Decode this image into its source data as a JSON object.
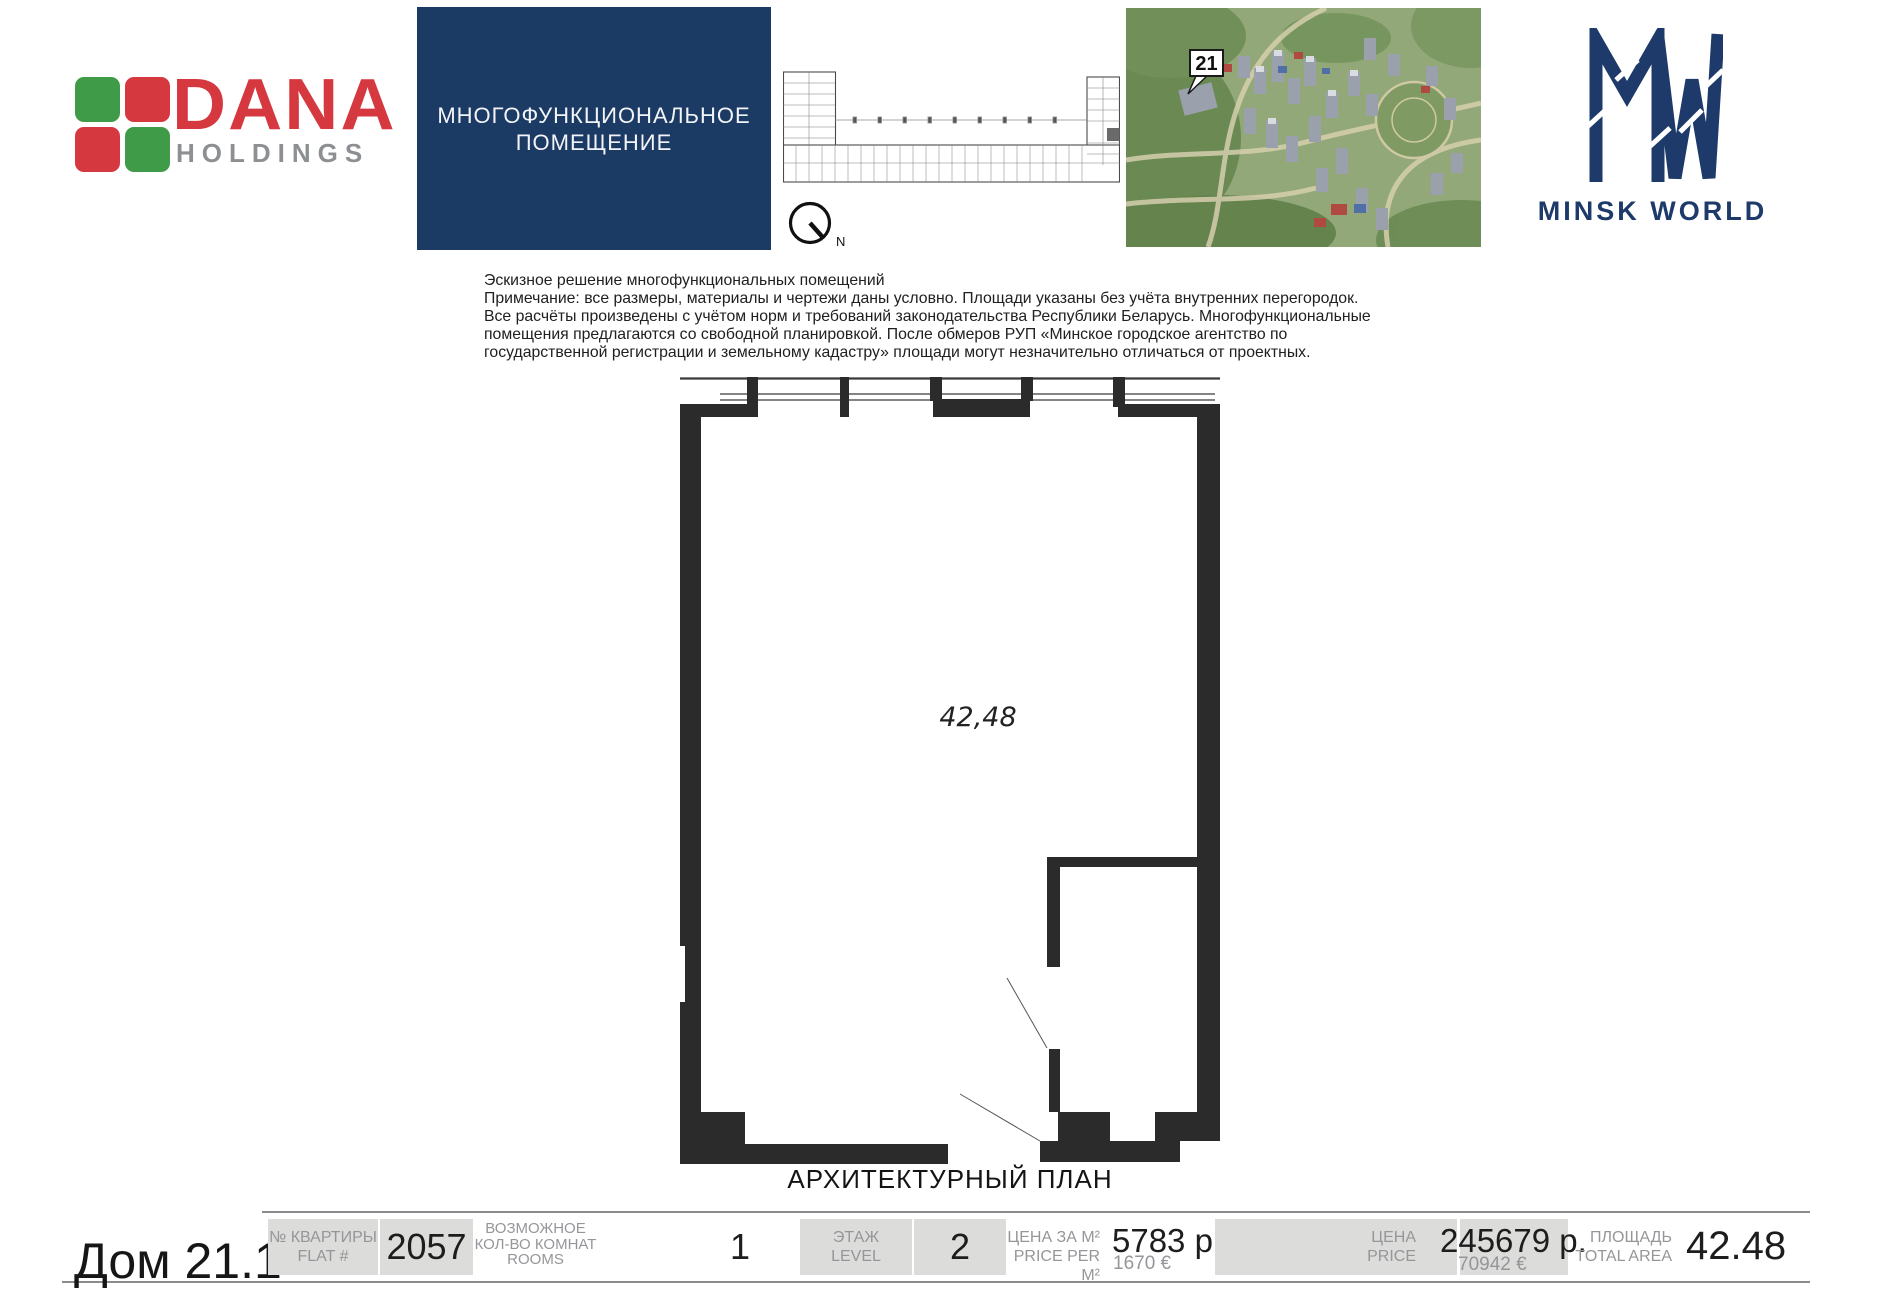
{
  "brand": {
    "dana_name": "DANA",
    "dana_sub": "HOLDINGS",
    "minsk_world": "MINSK WORLD"
  },
  "banner": {
    "line1": "МНОГОФУНКЦИОНАЛЬНОЕ",
    "line2": "ПОМЕЩЕНИЕ"
  },
  "site_plan": {
    "compass_label": "N",
    "building_marker": "21"
  },
  "disclaimer": {
    "lines": [
      "Эскизное решение многофункциональных помещений",
      "Примечание: все размеры, материалы и чертежи даны условно. Площади указаны без учёта внутренних перегородок.",
      "Все расчёты произведены с учётом норм и требований законодательства Республики Беларусь. Многофункциональные",
      "помещения предлагаются со свободной планировкой. После обмеров РУП «Минское городское агентство по",
      "государственной регистрации и земельному кадастру» площади могут незначительно отличаться от проектных."
    ]
  },
  "floor_plan": {
    "area_label": "42,48",
    "caption": "АРХИТЕКТУРНЫЙ ПЛАН"
  },
  "info_bar": {
    "building": "Дом 21.1",
    "flat_label1": "№ КВАРТИРЫ",
    "flat_label2": "FLAT #",
    "flat_value": "2057",
    "rooms_label1": "ВОЗМОЖНОЕ",
    "rooms_label2": "КОЛ-ВО КОМНАТ",
    "rooms_label3": "ROOMS",
    "rooms_value": "1",
    "level_label1": "ЭТАЖ",
    "level_label2": "LEVEL",
    "level_value": "2",
    "ppm_label1": "ЦЕНА ЗА М²",
    "ppm_label2": "PRICE PER M²",
    "ppm_byn": "5783 р.",
    "ppm_eur": "1670 €",
    "price_label1": "ЦЕНА",
    "price_label2": "PRICE",
    "price_byn": "245679 р.",
    "price_eur": "70942 €",
    "area_label1": "ПЛОЩАДЬ",
    "area_label2": "TOTAL AREA",
    "area_value": "42.48"
  },
  "colors": {
    "banner_navy": "#1b3a64",
    "logo_navy": "#1e3a6a",
    "dana_red": "#d63840",
    "dana_green": "#3f9b48",
    "plan_ink": "#2b2b2b",
    "box_gray": "#dcdcda",
    "label_gray": "#96969a"
  }
}
